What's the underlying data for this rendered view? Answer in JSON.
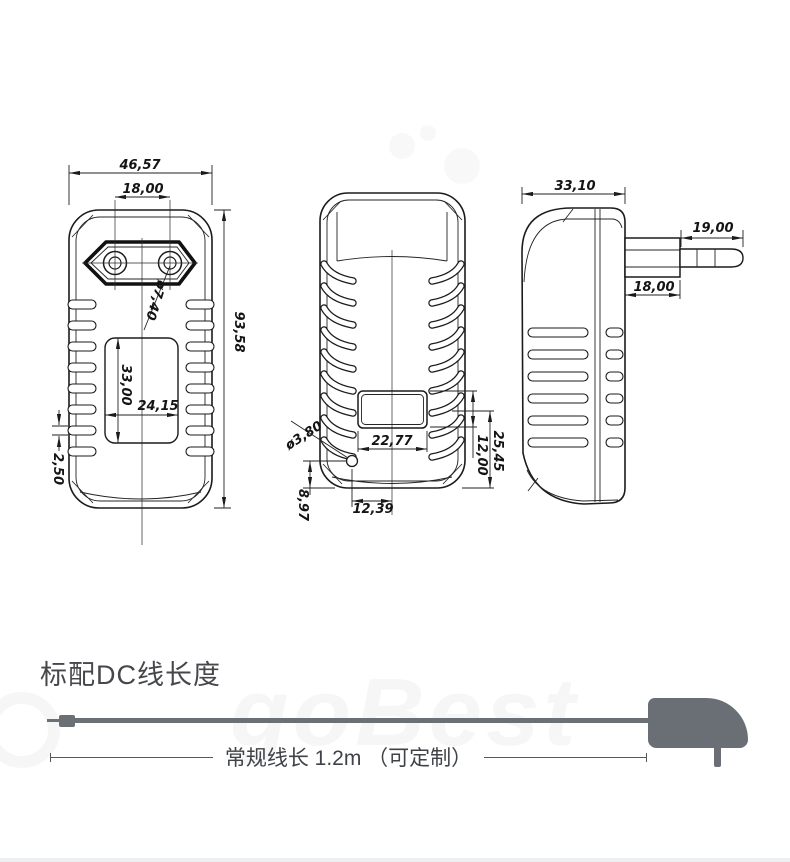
{
  "views": {
    "front": {
      "dims": {
        "width": "46,57",
        "pin_spacing": "18,00",
        "height": "93,58",
        "pin_diameter": "ø7,40",
        "label_height": "33,00",
        "label_width": "24,15",
        "vent_height": "2,50"
      }
    },
    "back": {
      "dims": {
        "led_diameter": "ø3,80",
        "window_width": "22,77",
        "window_height": "12,00",
        "window_to_bottom": "25,45",
        "led_offset_x": "12,39",
        "led_to_bottom": "8,97"
      }
    },
    "side": {
      "dims": {
        "depth": "33,10",
        "pin_length": "19,00",
        "plug_base_depth": "18,00"
      }
    }
  },
  "cable_section": {
    "heading": "标配DC线长度",
    "length_label": "常规线长 1.2m （可定制）"
  },
  "watermark": {
    "text": "goBest"
  },
  "colors": {
    "line": "#1b1b1b",
    "cable": "#6b7076",
    "heading_text": "#45474b",
    "note_text": "#3f4247"
  }
}
